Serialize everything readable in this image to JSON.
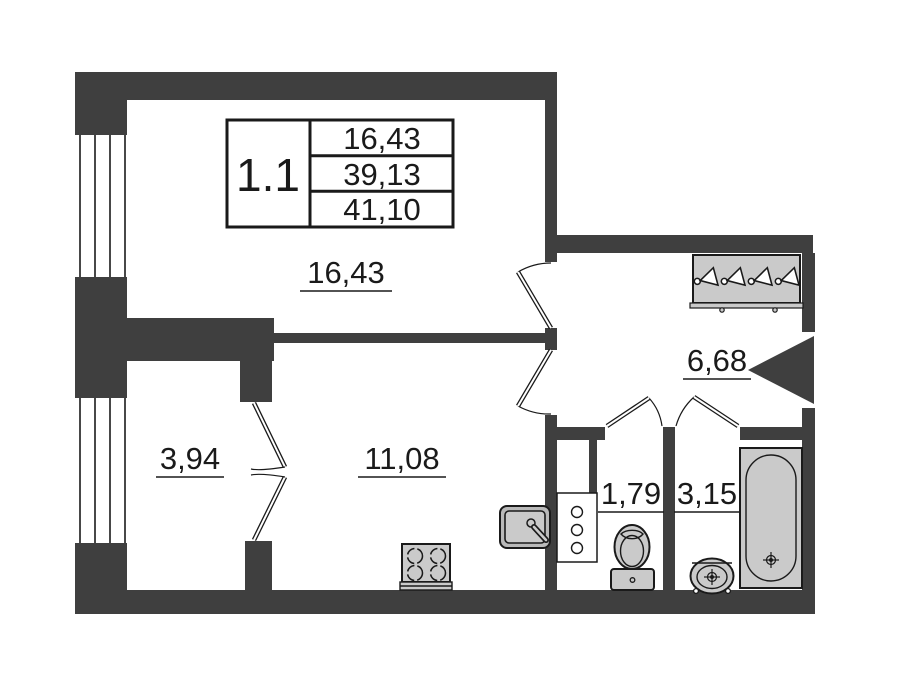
{
  "plan": {
    "unit_table": {
      "unit": "1.1",
      "values": [
        "16,43",
        "39,13",
        "41,10"
      ]
    },
    "rooms": {
      "living": "16,43",
      "balcony": "3,94",
      "kitchen": "11,08",
      "hall": "6,68",
      "wc": "1,79",
      "bath": "3,15"
    },
    "colors": {
      "wall": "#3f3f3f",
      "fixture": "#cacaca",
      "fixture_dark": "#b9b9b9",
      "line": "#1a1a1a",
      "background": "#ffffff"
    }
  }
}
